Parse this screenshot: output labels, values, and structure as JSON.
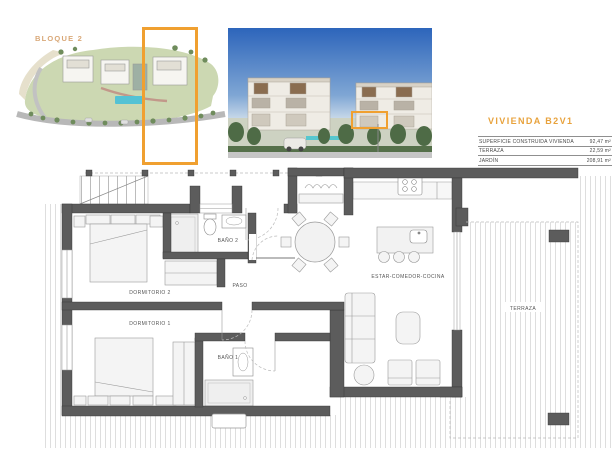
{
  "colors": {
    "accent_orange": "#F0A030",
    "title_orange": "#E8A23C",
    "wall_gray": "#5C5C5C",
    "stripe_gray": "#DEDEDE"
  },
  "siteplan": {
    "block_label": "BLOQUE 2"
  },
  "unit_info": {
    "title": "VIVIENDA B2V1",
    "areas": [
      {
        "label": "SUPERFICIE CONSTRUIDA VIVIENDA",
        "value": "92,47 m²"
      },
      {
        "label": "TERRAZA",
        "value": "22,59 m²"
      },
      {
        "label": "JARDÍN",
        "value": "208,91 m²"
      }
    ]
  },
  "floorplan": {
    "rooms": {
      "dormitorio2": "DORMITORIO 2",
      "dormitorio1": "DORMITORIO 1",
      "bano2": "BAÑO 2",
      "bano1": "BAÑO 1",
      "paso": "PASO",
      "estar_comedor_cocina": "ESTAR-COMEDOR-COCINA",
      "terraza": "TERRAZA"
    }
  }
}
